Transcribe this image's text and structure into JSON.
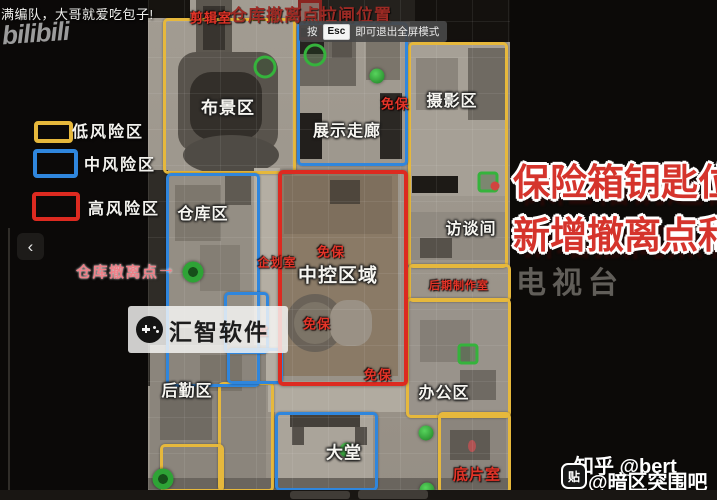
{
  "colors": {
    "low_risk": "#e6b83c",
    "mid_risk": "#2f86dd",
    "high_risk": "#dd2a20",
    "label_red": "#e33428",
    "headline_red": "#d5342c",
    "evac_pink": "#ef8088",
    "marker_green": "#35b33c"
  },
  "top": {
    "caption": "满编队，大哥就爱吃包子!",
    "logo": "bilibili",
    "title": "仓库撤离点拉闸位置",
    "tooltip_prefix": "按",
    "tooltip_key": "Esc",
    "tooltip_suffix": "即可退出全屏模式"
  },
  "legend": {
    "items": [
      {
        "label": "低风险区",
        "risk": "low"
      },
      {
        "label": "中风险区",
        "risk": "mid"
      },
      {
        "label": "高风险区",
        "risk": "high"
      }
    ],
    "evac_label": "仓库撤离点",
    "evac_arrow": "→",
    "back_chevron": "‹"
  },
  "right_panel": {
    "headline_line1": "保险箱钥匙位置",
    "headline_line2": "新增撤离点和拉",
    "map_watermark": "电视台"
  },
  "watermarks": {
    "center_text": "汇智软件",
    "zhihu": "知乎 @bert",
    "tieba_handle": "@暗区突围吧",
    "tieba_icon": "贴"
  },
  "map": {
    "room_labels": [
      {
        "text": "布景区",
        "x": 228,
        "y": 106,
        "size": 17
      },
      {
        "text": "展示走廊",
        "x": 347,
        "y": 129,
        "size": 16
      },
      {
        "text": "摄影区",
        "x": 452,
        "y": 99,
        "size": 16
      },
      {
        "text": "访谈间",
        "x": 471,
        "y": 227,
        "size": 16
      },
      {
        "text": "中控区域",
        "x": 338,
        "y": 274,
        "size": 19
      },
      {
        "text": "仓库区",
        "x": 203,
        "y": 212,
        "size": 16
      },
      {
        "text": "后勤区",
        "x": 187,
        "y": 389,
        "size": 16
      },
      {
        "text": "办公区",
        "x": 444,
        "y": 391,
        "size": 16
      },
      {
        "text": "大堂",
        "x": 344,
        "y": 451,
        "size": 17
      }
    ],
    "red_labels": [
      {
        "text": "剪辑室",
        "x": 211,
        "y": 17,
        "size": 13
      },
      {
        "text": "免保",
        "x": 395,
        "y": 103,
        "size": 13
      },
      {
        "text": "免保",
        "x": 331,
        "y": 251,
        "size": 13
      },
      {
        "text": "免保",
        "x": 317,
        "y": 323,
        "size": 13
      },
      {
        "text": "免保",
        "x": 378,
        "y": 374,
        "size": 13
      },
      {
        "text": "企划室",
        "x": 277,
        "y": 262,
        "size": 12
      },
      {
        "text": "室",
        "x": 263,
        "y": 331,
        "size": 11
      },
      {
        "text": "后期制作室",
        "x": 459,
        "y": 285,
        "size": 11
      },
      {
        "text": "底片室",
        "x": 477,
        "y": 474,
        "size": 15
      }
    ],
    "zone_boxes": [
      {
        "risk": "low",
        "x": 163,
        "y": 18,
        "w": 127,
        "h": 150
      },
      {
        "risk": "low",
        "x": 408,
        "y": 42,
        "w": 94,
        "h": 220
      },
      {
        "risk": "low",
        "x": 408,
        "y": 264,
        "w": 97,
        "h": 32
      },
      {
        "risk": "low",
        "x": 406,
        "y": 298,
        "w": 99,
        "h": 114
      },
      {
        "risk": "low",
        "x": 438,
        "y": 412,
        "w": 67,
        "h": 76
      },
      {
        "risk": "low",
        "x": 218,
        "y": 382,
        "w": 50,
        "h": 104
      },
      {
        "risk": "low",
        "x": 160,
        "y": 444,
        "w": 58,
        "h": 42
      },
      {
        "risk": "mid",
        "x": 297,
        "y": 22,
        "w": 105,
        "h": 138
      },
      {
        "risk": "mid",
        "x": 166,
        "y": 173,
        "w": 88,
        "h": 208
      },
      {
        "risk": "mid",
        "x": 224,
        "y": 292,
        "w": 39,
        "h": 56
      },
      {
        "risk": "mid",
        "x": 227,
        "y": 348,
        "w": 50,
        "h": 30
      },
      {
        "risk": "mid",
        "x": 275,
        "y": 412,
        "w": 97,
        "h": 73
      },
      {
        "risk": "high",
        "x": 278,
        "y": 170,
        "w": 122,
        "h": 208
      }
    ],
    "markers": [
      {
        "x": 265,
        "y": 67,
        "type": "ring"
      },
      {
        "x": 315,
        "y": 55,
        "type": "ring"
      },
      {
        "x": 377,
        "y": 76,
        "type": "dot"
      },
      {
        "x": 193,
        "y": 272,
        "type": "doticon"
      },
      {
        "x": 163,
        "y": 479,
        "type": "doticon"
      },
      {
        "x": 488,
        "y": 182,
        "type": "square"
      },
      {
        "x": 495,
        "y": 186,
        "type": "reddot"
      },
      {
        "x": 468,
        "y": 354,
        "type": "square"
      },
      {
        "x": 426,
        "y": 433,
        "type": "dot"
      },
      {
        "x": 427,
        "y": 490,
        "type": "dot"
      },
      {
        "x": 347,
        "y": 450,
        "type": "dot"
      }
    ]
  }
}
